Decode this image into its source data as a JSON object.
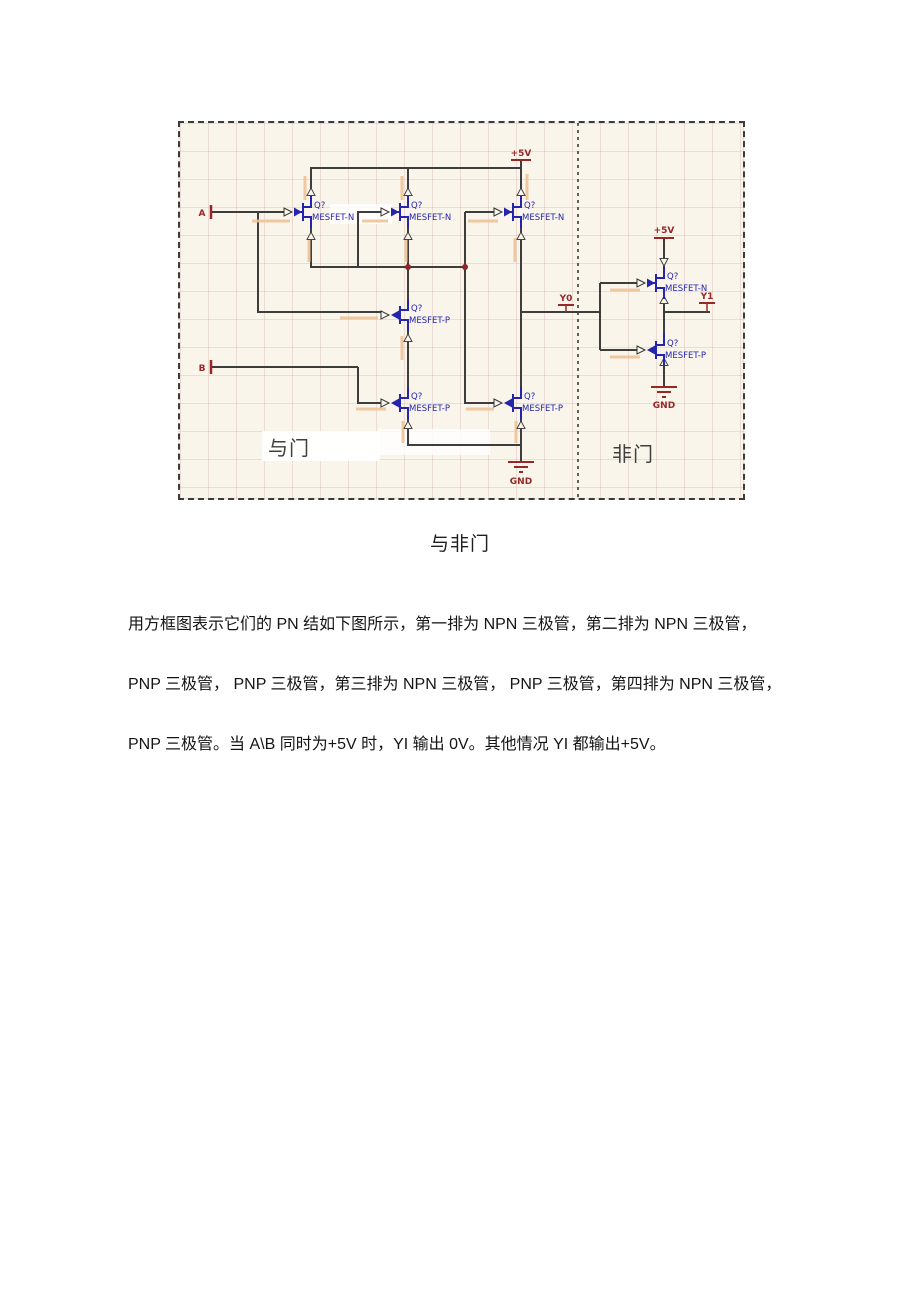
{
  "document": {
    "caption": "与非门",
    "paragraph_lines": [
      "用方框图表示它们的 PN 结如下图所示，第一排为 NPN 三极管，第二排为 NPN 三极管，",
      "PNP 三极管， PNP 三极管，第三排为 NPN 三极管， PNP 三极管，第四排为 NPN 三极管，",
      "PNP 三极管。当 A\\B 同时为+5V 时，YI 输出 0V。其他情况 YI 都输出+5V。"
    ]
  },
  "schematic": {
    "and_gate_label": "与门",
    "not_gate_label": "非门",
    "ports": {
      "a": "A",
      "b": "B",
      "y0": "Y0",
      "y1": "Y1"
    },
    "power": {
      "vcc": "+5V",
      "gnd": "GND"
    },
    "transistors": [
      {
        "designator": "Q?",
        "type": "MESFET-N"
      },
      {
        "designator": "Q?",
        "type": "MESFET-N"
      },
      {
        "designator": "Q?",
        "type": "MESFET-N"
      },
      {
        "designator": "Q?",
        "type": "MESFET-P"
      },
      {
        "designator": "Q?",
        "type": "MESFET-P"
      },
      {
        "designator": "Q?",
        "type": "MESFET-P"
      },
      {
        "designator": "Q?",
        "type": "MESFET-N"
      },
      {
        "designator": "Q?",
        "type": "MESFET-P"
      }
    ],
    "icons": [
      "ground-icon",
      "power-bar-icon",
      "junction-dot-icon",
      "gate-arrow-icon",
      "pin-arrow-icon",
      "net-flag-icon"
    ],
    "colors": {
      "canvas": "#faf5eb",
      "wire": "#3d3d3d",
      "symbol_blue": "#2424ac",
      "net_red": "#962828",
      "highlight_tan": "#eec397"
    }
  }
}
